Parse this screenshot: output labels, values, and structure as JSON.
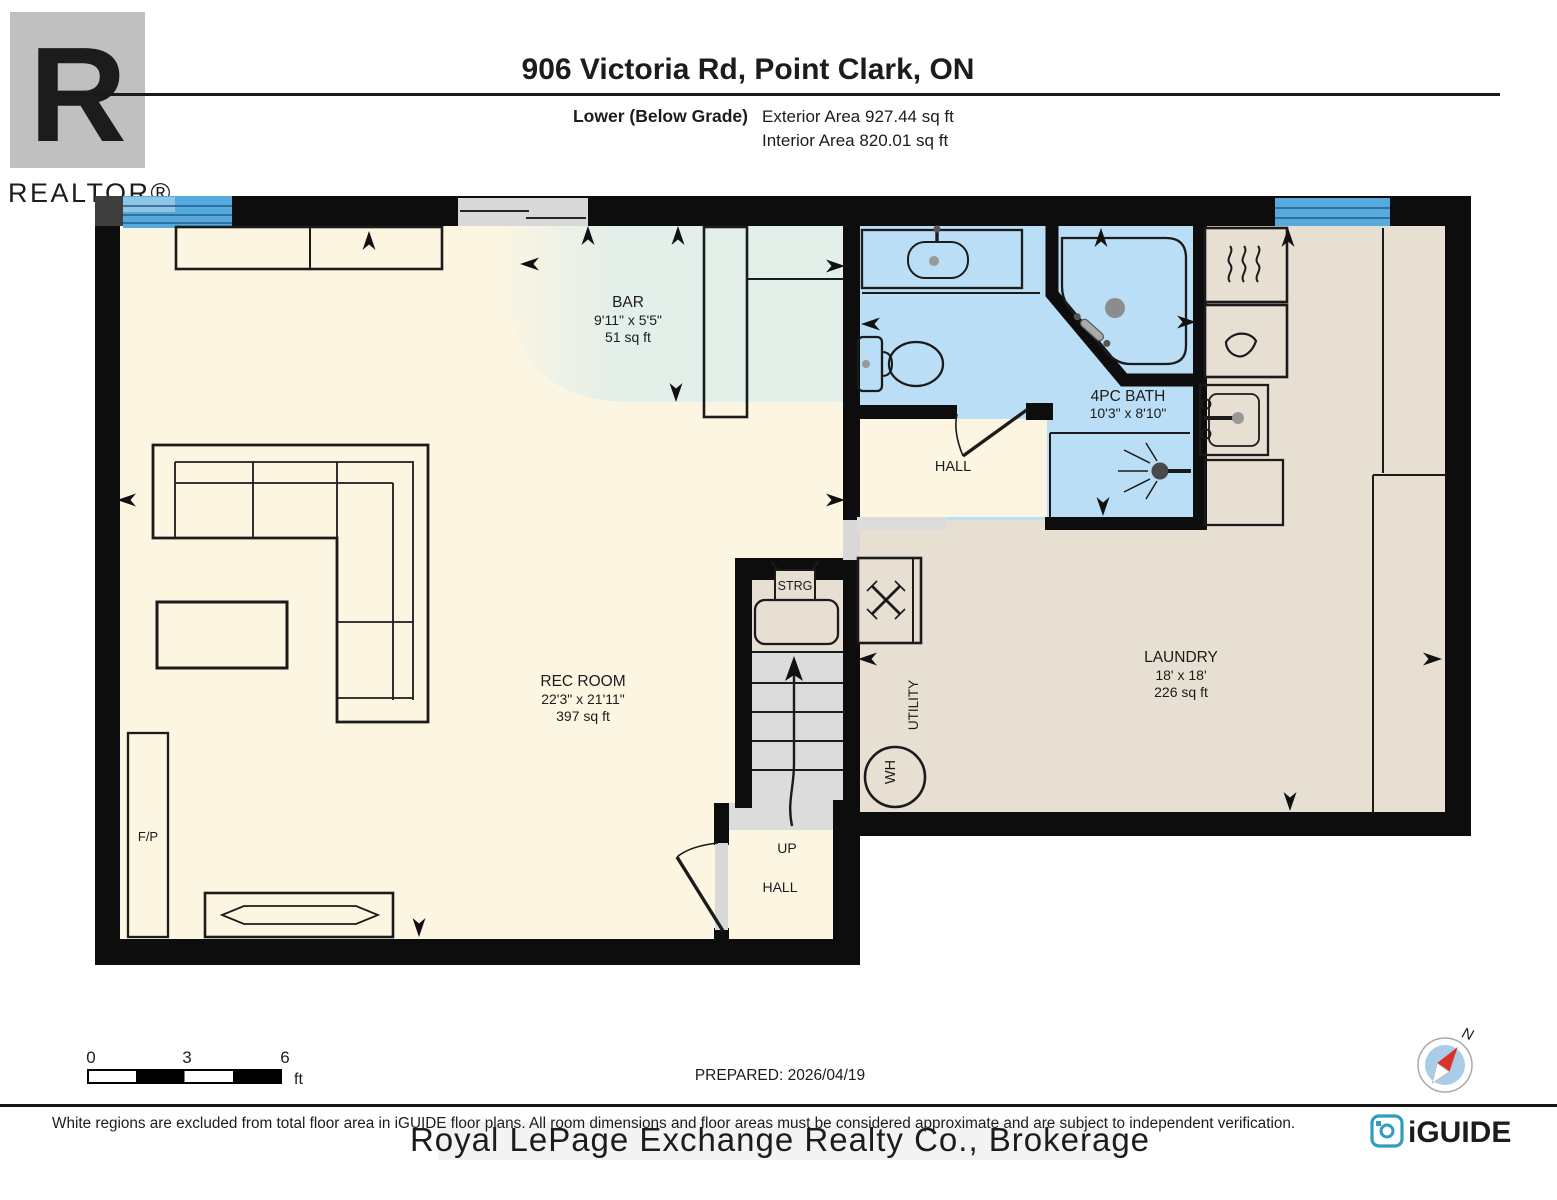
{
  "header": {
    "title": "906 Victoria Rd, Point Clark, ON",
    "level_label": "Lower (Below Grade)",
    "exterior_area": "Exterior Area 927.44 sq ft",
    "interior_area": "Interior Area 820.01 sq ft"
  },
  "branding": {
    "realtor_letter": "R",
    "realtor_label": "REALTOR®",
    "iguide_label": "iGUIDE",
    "compass_north": "N"
  },
  "rooms": {
    "bar": {
      "name": "BAR",
      "dims": "9'11\" x 5'5\"",
      "area": "51 sq ft"
    },
    "rec_room": {
      "name": "REC ROOM",
      "dims": "22'3\" x 21'11\"",
      "area": "397 sq ft"
    },
    "bath": {
      "name": "4PC BATH",
      "dims": "10'3\" x 8'10\""
    },
    "hall": {
      "name": "HALL"
    },
    "laundry": {
      "name": "LAUNDRY",
      "dims": "18' x 18'",
      "area": "226 sq ft"
    },
    "utility": {
      "name": "UTILITY"
    },
    "storage": {
      "name": "STRG"
    },
    "stair_direction": {
      "name": "UP"
    },
    "hall_lower": {
      "name": "HALL"
    },
    "fireplace": {
      "name": "F/P"
    },
    "water_heater": {
      "name": "WH"
    }
  },
  "footer": {
    "scale_ticks": [
      "0",
      "3",
      "6"
    ],
    "scale_unit": "ft",
    "prepared": "PREPARED: 2026/04/19",
    "disclaimer": "White regions are excluded from total floor area in iGUIDE floor plans. All room dimensions and floor areas must be considered approximate and are subject to independent verification.",
    "watermark": "Royal LePage Exchange Realty Co., Brokerage"
  },
  "colors": {
    "wall": "#0d0d0d",
    "room_fill": "#fcf5e2",
    "bar_fill": "#e3efe9",
    "bath_fill": "#badef5",
    "laundry_fill": "#e6dfd2",
    "stairs_fill": "#dcdcdc",
    "window": "#57aade",
    "iguide_teal": "#2f9dbf",
    "compass_red": "#db3327"
  }
}
